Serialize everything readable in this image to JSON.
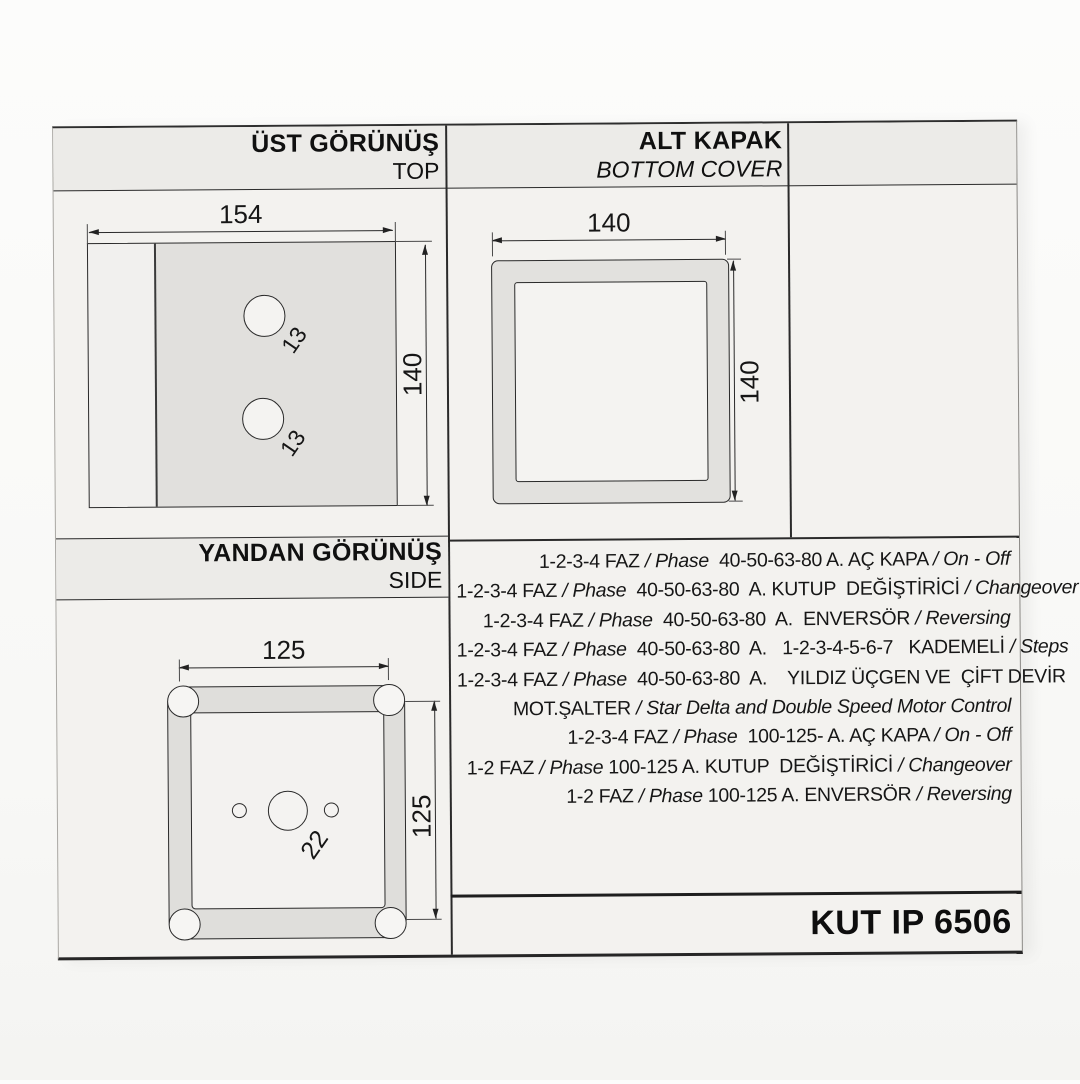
{
  "header": {
    "top_view": {
      "title": "ÜST GÖRÜNÜŞ",
      "subtitle": "TOP"
    },
    "bottom_cover": {
      "title": "ALT KAPAK",
      "subtitle": "BOTTOM COVER"
    },
    "side_view": {
      "title": "YANDAN GÖRÜNÜŞ",
      "subtitle": "SIDE"
    }
  },
  "drawings": {
    "top_view": {
      "width": "154",
      "height": "140",
      "hole1": "13",
      "hole2": "13"
    },
    "bottom_cover": {
      "width": "140",
      "height": "140"
    },
    "side_view": {
      "width": "125",
      "height": "125",
      "center_hole": "22"
    }
  },
  "specs": [
    {
      "parts": [
        {
          "text": "1-2-3-4 FAZ ",
          "italic": false
        },
        {
          "text": "/ Phase",
          "italic": true
        },
        {
          "text": "  40-50-63-80 A. AÇ KAPA ",
          "italic": false
        },
        {
          "text": "/ On - Off",
          "italic": true
        }
      ]
    },
    {
      "parts": [
        {
          "text": "1-2-3-4 FAZ ",
          "italic": false
        },
        {
          "text": "/ Phase",
          "italic": true
        },
        {
          "text": "  40-50-63-80  A. KUTUP  DEĞİŞTİRİCİ ",
          "italic": false
        },
        {
          "text": "/ Changeover",
          "italic": true
        }
      ]
    },
    {
      "parts": [
        {
          "text": "1-2-3-4 FAZ ",
          "italic": false
        },
        {
          "text": "/ Phase",
          "italic": true
        },
        {
          "text": "  40-50-63-80  A.  ENVERSÖR ",
          "italic": false
        },
        {
          "text": "/ Reversing",
          "italic": true
        }
      ]
    },
    {
      "parts": [
        {
          "text": "1-2-3-4 FAZ ",
          "italic": false
        },
        {
          "text": "/ Phase",
          "italic": true
        },
        {
          "text": "  40-50-63-80  A.   1-2-3-4-5-6-7   KADEMELİ ",
          "italic": false
        },
        {
          "text": "/ Steps",
          "italic": true
        }
      ]
    },
    {
      "parts": [
        {
          "text": "1-2-3-4 FAZ ",
          "italic": false
        },
        {
          "text": "/ Phase",
          "italic": true
        },
        {
          "text": "  40-50-63-80  A.    YILDIZ ÜÇGEN VE  ÇİFT DEVİR",
          "italic": false
        }
      ]
    },
    {
      "parts": [
        {
          "text": "MOT.ŞALTER ",
          "italic": false
        },
        {
          "text": "/ Star Delta and Double Speed Motor Control",
          "italic": true
        }
      ]
    },
    {
      "parts": [
        {
          "text": "1-2-3-4 FAZ ",
          "italic": false
        },
        {
          "text": "/ Phase",
          "italic": true
        },
        {
          "text": "  100-125- A. AÇ KAPA ",
          "italic": false
        },
        {
          "text": "/ On - Off",
          "italic": true
        }
      ]
    },
    {
      "parts": [
        {
          "text": "1-2 FAZ ",
          "italic": false
        },
        {
          "text": "/ Phase",
          "italic": true
        },
        {
          "text": " 100-125 A. KUTUP  DEĞİŞTİRİCİ ",
          "italic": false
        },
        {
          "text": "/ Changeover",
          "italic": true
        }
      ]
    },
    {
      "parts": [
        {
          "text": "1-2 FAZ ",
          "italic": false
        },
        {
          "text": "/ Phase",
          "italic": true
        },
        {
          "text": " 100-125 A. ENVERSÖR ",
          "italic": false
        },
        {
          "text": "/ Reversing",
          "italic": true
        }
      ]
    }
  ],
  "footer": {
    "model": "KUT IP 6506"
  }
}
